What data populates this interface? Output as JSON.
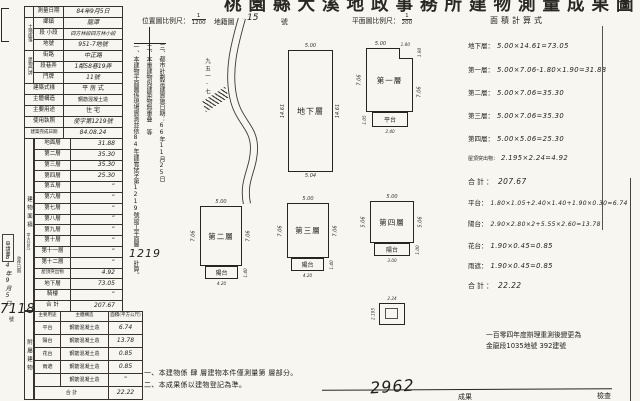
{
  "colors": {
    "paper": "#f7f6f1",
    "ink": "#23221e"
  },
  "corner_mark": "2",
  "title": "桃園縣大溪地政事務所建物測量成果圖",
  "header": {
    "loc_scale_label": "位置圖比例尺：",
    "loc_scale_num": "1",
    "loc_scale_den": "1200",
    "sheet_label": "地籍圖",
    "sheet_no": "15",
    "sheet_unit": "號",
    "plan_scale_label": "平面圖比例尺：",
    "plan_scale_num": "1",
    "plan_scale_den": "200",
    "calc_title": "面積計算式"
  },
  "info": {
    "land_group": "土地座落",
    "house_group": "建物門牌",
    "rows": [
      {
        "label": "測量日期",
        "value": "84年9月5日"
      },
      {
        "label": "鄉鎮",
        "value": "龍潭"
      },
      {
        "label": "段 小段",
        "value": "四方林段四方林小段"
      },
      {
        "label": "地號",
        "value": "951-7地號"
      },
      {
        "label": "街路",
        "value": "中正路"
      },
      {
        "label": "段巷弄",
        "value": "1鄰58巷19弄"
      },
      {
        "label": "門牌",
        "value": "11號"
      },
      {
        "label": "建築式樣",
        "value": "平 房 式"
      },
      {
        "label": "主體構造",
        "value": "鋼筋混凝土造"
      },
      {
        "label": "主要用途",
        "value": "住 宅"
      },
      {
        "label": "使用執照",
        "value": "使字第1219號"
      },
      {
        "label": "建築完成日期",
        "value": "84.08.24"
      }
    ]
  },
  "floors": {
    "side_label": "建物面積",
    "side_unit": "（平方公尺）",
    "rows": [
      {
        "label": "地面層",
        "value": "31.88"
      },
      {
        "label": "第二層",
        "value": "35.30"
      },
      {
        "label": "第三層",
        "value": "35.30"
      },
      {
        "label": "第四層",
        "value": "25.30"
      },
      {
        "label": "第五層",
        "value": "”"
      },
      {
        "label": "第六層",
        "value": "”"
      },
      {
        "label": "第七層",
        "value": "”"
      },
      {
        "label": "第八層",
        "value": "”"
      },
      {
        "label": "第九層",
        "value": "”"
      },
      {
        "label": "第十層",
        "value": "”"
      },
      {
        "label": "第十一層",
        "value": "”"
      },
      {
        "label": "第十二層",
        "value": "”"
      },
      {
        "label": "屋頂突出物",
        "value": "4.92"
      },
      {
        "label": "地下層",
        "value": "73.05"
      },
      {
        "label": "騎樓",
        "value": "”"
      }
    ],
    "total_label": "合 計",
    "total_value": "207.67"
  },
  "annex": {
    "side_label": "附屬建物",
    "headers": [
      "主要用途",
      "主體構造",
      "面積(平方公尺)"
    ],
    "rows": [
      {
        "use": "平台",
        "structure": "鋼筋混凝土造",
        "area": "6.74"
      },
      {
        "use": "陽台",
        "structure": "鋼筋混凝土造",
        "area": "13.78"
      },
      {
        "use": "花台",
        "structure": "鋼筋混凝土造",
        "area": "0.85"
      },
      {
        "use": "雨遮",
        "structure": "鋼筋混凝土造",
        "area": "0.85"
      },
      {
        "use": "",
        "structure": "鋼筋混凝土造",
        "area": "”"
      }
    ],
    "total_label": "合 計",
    "total_value": "22.22"
  },
  "margin": {
    "application": "申請書",
    "receipt_label": "收件日期",
    "receipt_date": "84年9月5日",
    "receipt_no": "7118",
    "receipt_no_unit": "號",
    "permit_no": "1219"
  },
  "notes_vertical": [
    "三、都市計劃禁建實施日期：66年11月25日",
    "二、本重建物與建築物無重叠 等",
    "一、本建物平面圖係現場實測並依84年建管使字第1219號竣工平面圖繪製計算。"
  ],
  "map": {
    "lot_label": "九五一-七"
  },
  "plans": {
    "basement": {
      "name": "地下層",
      "dim_top": "5.00",
      "dim_bottom": "5.04",
      "dim_left": "14.61",
      "dim_right": "14.61"
    },
    "f1": {
      "name": "第一層",
      "dim_top": "5.00",
      "dim_left": "7.06",
      "dim_right": "7.06",
      "notch_w": "1.80",
      "notch_h": "1.90",
      "annex_name": "平台",
      "annex_bottom": "2.40",
      "annex_left": "1.05"
    },
    "f2": {
      "name": "第二層",
      "dim_top": "5.00",
      "dim_left": "7.06",
      "dim_right": "7.06",
      "annex_name": "陽台",
      "annex_bottom": "4.20",
      "annex_right": "1.40"
    },
    "f3": {
      "name": "第三層",
      "dim_top": "5.00",
      "dim_left": "7.06",
      "dim_right": "7.06",
      "annex_name": "陽台",
      "annex_bottom": "4.20",
      "annex_right": "1.40"
    },
    "f4": {
      "name": "第四層",
      "dim_top": "5.00",
      "dim_left": "5.06",
      "dim_right": "5.06",
      "annex_name": "陽台",
      "annex_bottom": "3.00",
      "annex_right": "1.00"
    },
    "roof": {
      "dim_top": "2.24",
      "dim_left": "2.195"
    }
  },
  "calc": {
    "rows": [
      {
        "label": "地下層：",
        "formula": "5.00×14.61=73.05"
      },
      {
        "label": "第一層：",
        "formula": "5.00×7.06-1.80×1.90=31.88"
      },
      {
        "label": "第二層：",
        "formula": "5.00×7.06=35.30"
      },
      {
        "label": "第三層：",
        "formula": "5.00×7.06=35.30"
      },
      {
        "label": "第四層：",
        "formula": "5.00×5.06=25.30"
      },
      {
        "label": "屋頂突出物：",
        "formula": "2.195×2.24=4.92"
      },
      {
        "label": "合計：",
        "formula": "207.67"
      },
      {
        "label": "平台：",
        "formula": "1.80×1.05+2.40×1.40+1.90×0.30=6.74"
      },
      {
        "label": "陽台：",
        "formula": "2.90×2.80×2+5.55×2.60=13.78"
      },
      {
        "label": "花台：",
        "formula": "1.90×0.45=0.85"
      },
      {
        "label": "雨遮：",
        "formula": "1.90×0.45=0.85"
      },
      {
        "label": "合計：",
        "formula": "22.22"
      }
    ]
  },
  "bottom_notes": [
    "一、本建物係 肆 層建物本件僅測量第   層部分。",
    "二、本成果係以建物登記為準。"
  ],
  "resurvey_note": [
    "一百零四年度辦理重測後變更為",
    "金龍段1035地號 392建號"
  ],
  "bottom_row": {
    "handwritten_no": "2962",
    "label_result": "成果",
    "label_check": "檢查"
  }
}
